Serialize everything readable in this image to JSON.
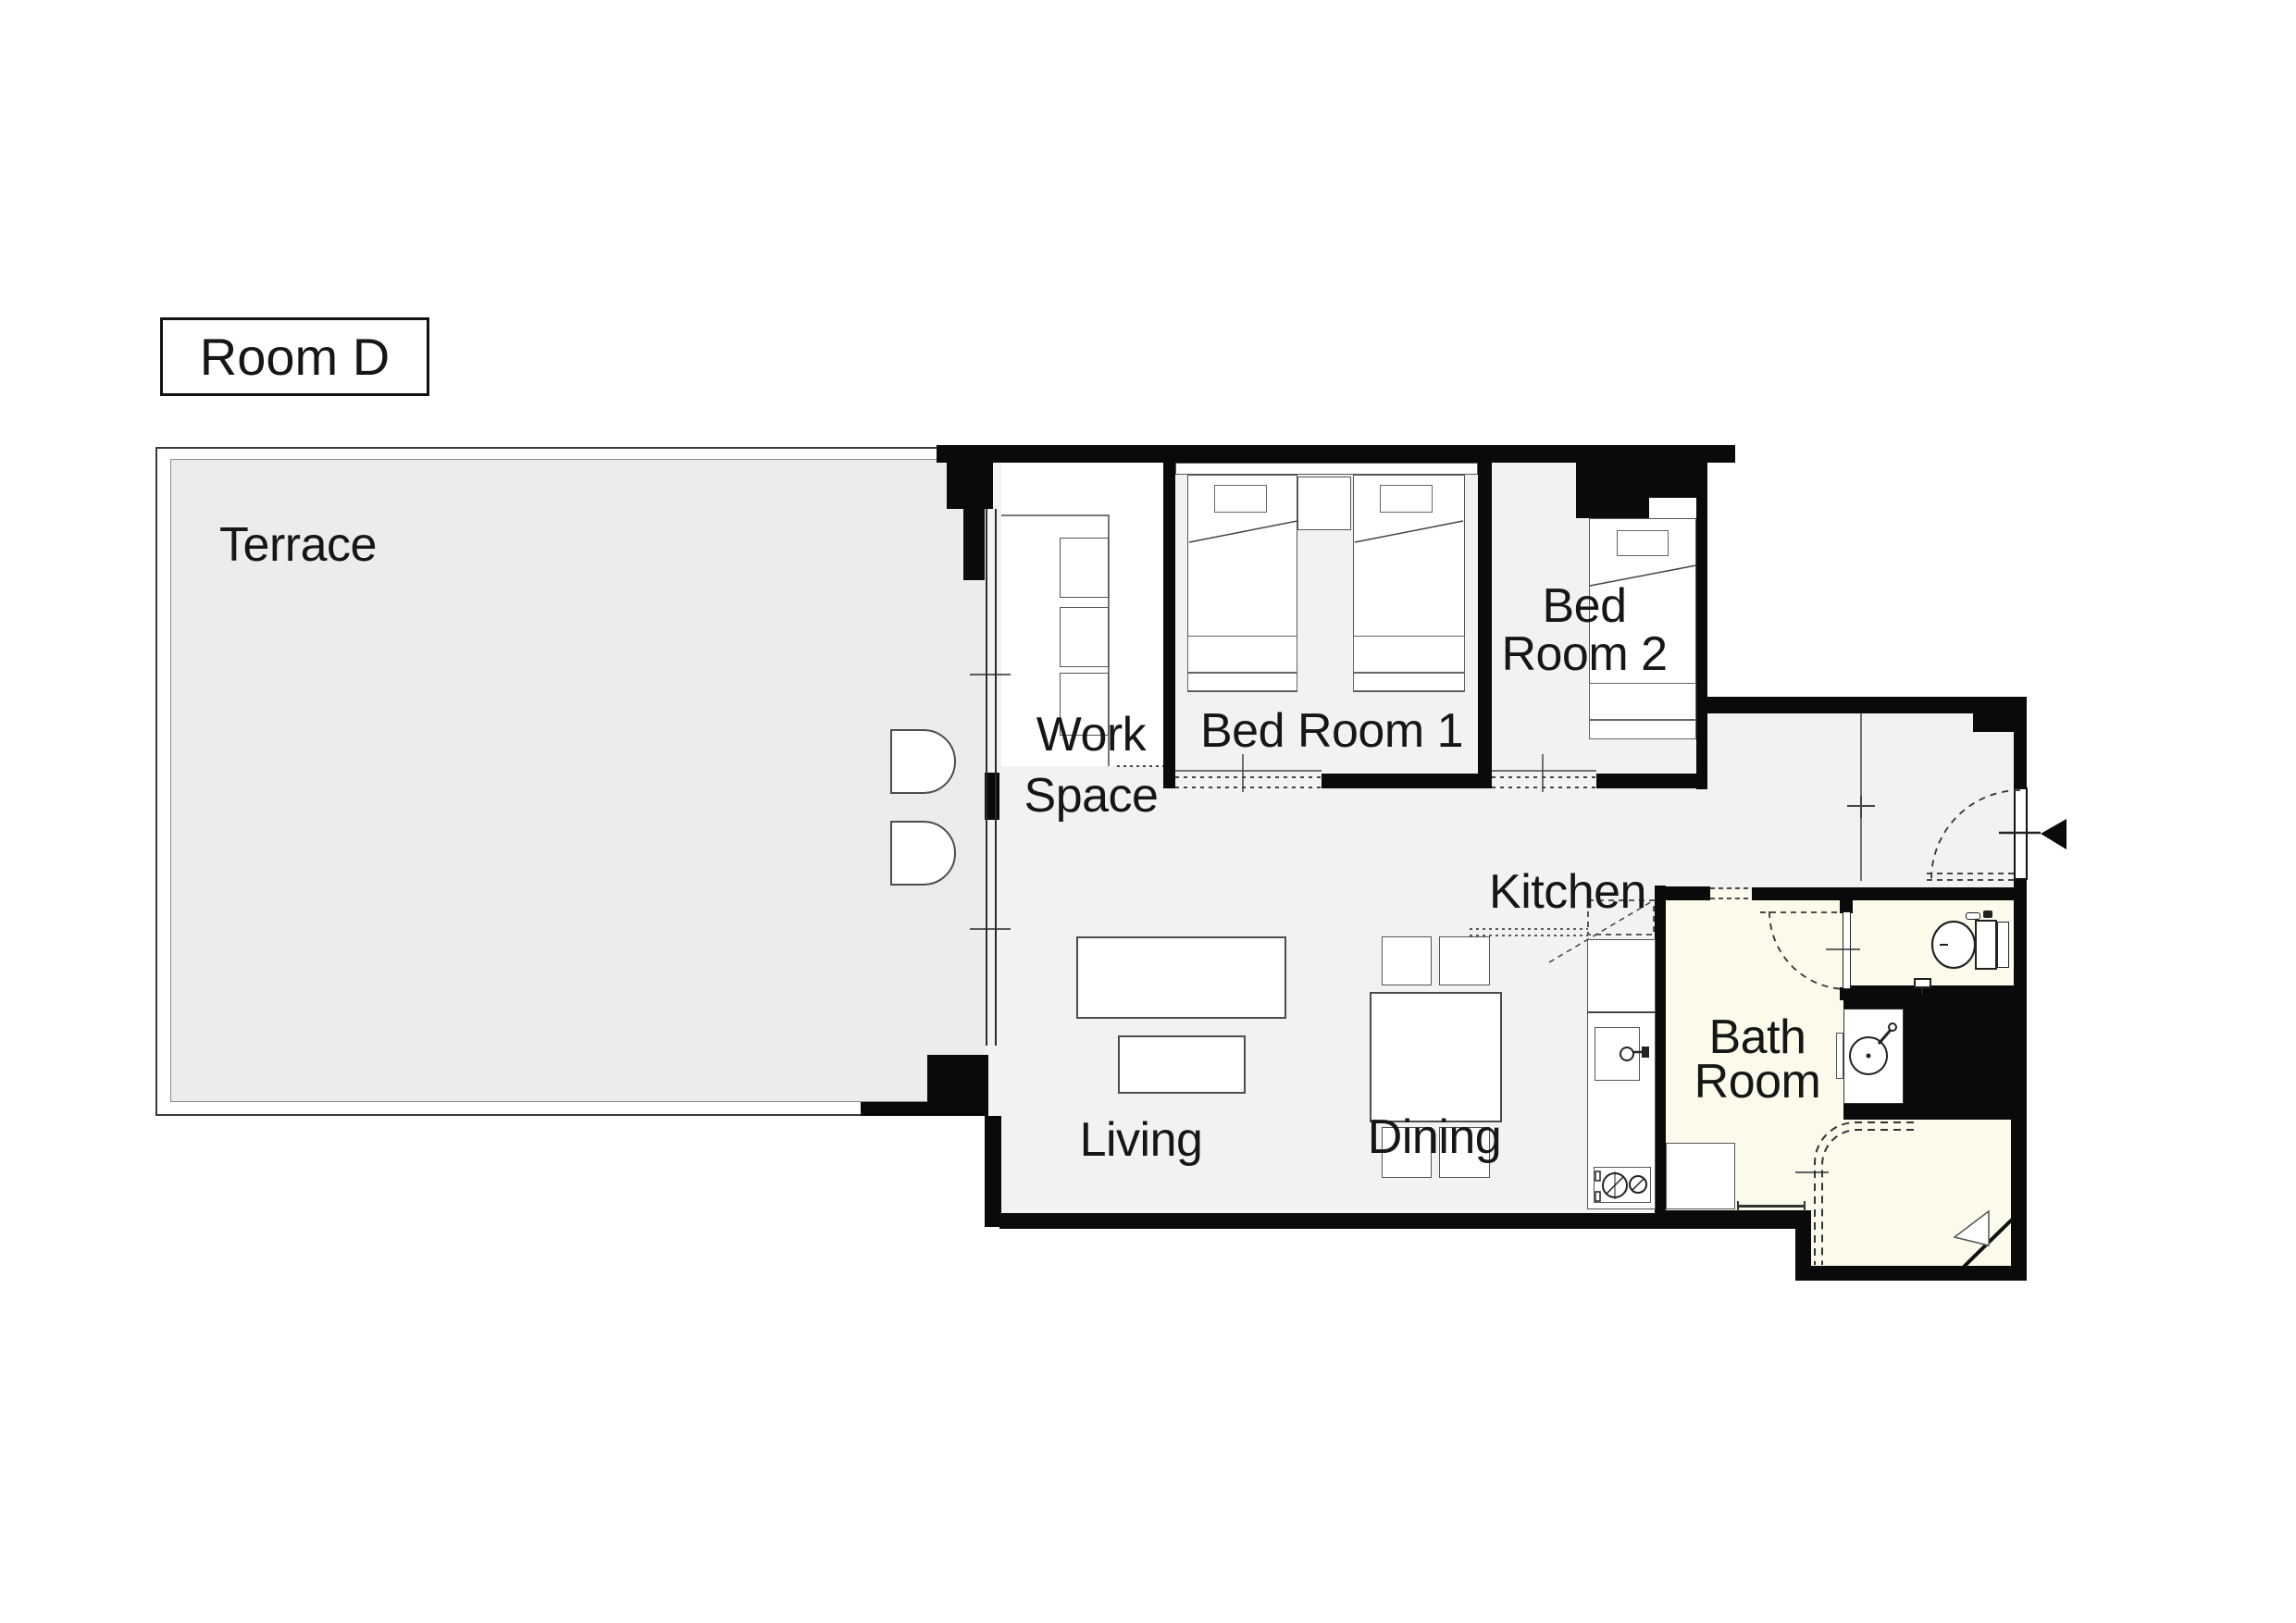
{
  "title": {
    "label": "Room D"
  },
  "rooms": {
    "terrace": {
      "label": "Terrace"
    },
    "work_space": {
      "line1": "Work",
      "line2": "Space"
    },
    "bed_room_1": {
      "label": "Bed Room 1"
    },
    "bed_room_2": {
      "line1": "Bed",
      "line2": "Room 2"
    },
    "kitchen": {
      "label": "Kitchen"
    },
    "living": {
      "label": "Living"
    },
    "dining": {
      "label": "Dining"
    },
    "bath_room": {
      "line1": "Bath",
      "line2": "Room"
    }
  },
  "colors": {
    "wall": "#0a0a0a",
    "interior_floor": "#f2f2f2",
    "terrace_floor": "#ececec",
    "wet_room_floor": "#fbfaeb",
    "furniture_fill": "#ffffff",
    "furniture_border": "#4d4d4d",
    "text": "#161616",
    "accent_red": "#e8120c"
  },
  "icons": {
    "entrance_arrow": "◀ black triangle pointing left at entry door",
    "door_swing": "dashed quarter-circle arc",
    "toilet": "toilet bowl with tank, top view",
    "washbasin": "round basin with faucet, top view",
    "stove": "two-burner cooktop, top view",
    "sink": "kitchen sink with faucet, top view"
  }
}
